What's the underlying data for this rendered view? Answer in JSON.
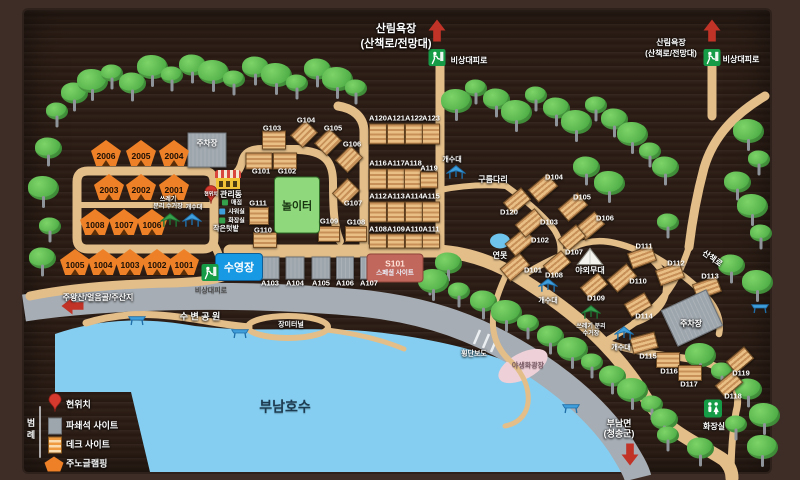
{
  "legend": {
    "title": "범례",
    "items": [
      {
        "icon": "pin",
        "label": "현위치"
      },
      {
        "icon": "gravel",
        "label": "파쇄석 사이트"
      },
      {
        "icon": "deck",
        "label": "데크 사이트"
      },
      {
        "icon": "glamping",
        "label": "주노글램핑"
      }
    ]
  },
  "colors": {
    "board": "#2c1d15",
    "road_tan": "#e3be89",
    "road_gray": "#a6adb4",
    "lake": "#85cef1",
    "tent_orange": "#ee8127",
    "deck_tan": "#e9bf85",
    "gravel_gray": "#9ea6ad",
    "pool_blue": "#1899e3",
    "playground_green": "#8fd87b",
    "special_red": "#c2675c",
    "exit_green": "#169c46",
    "arrow_red": "#c23327"
  },
  "map": {
    "tents": [
      [
        "2006",
        106,
        153
      ],
      [
        "2005",
        141,
        153
      ],
      [
        "2004",
        174,
        153
      ],
      [
        "2003",
        109,
        187
      ],
      [
        "2002",
        141,
        187
      ],
      [
        "2001",
        174,
        187
      ],
      [
        "1008",
        95,
        222
      ],
      [
        "1007",
        124,
        222
      ],
      [
        "1006",
        152,
        222
      ],
      [
        "1005",
        75,
        262
      ],
      [
        "1004",
        103,
        262
      ],
      [
        "1003",
        130,
        262
      ],
      [
        "1002",
        157,
        262
      ],
      [
        "1001",
        184,
        262
      ]
    ],
    "deck_sites": [
      [
        "A120",
        378,
        134,
        16,
        19,
        0,
        378,
        118
      ],
      [
        "A121",
        396,
        134,
        16,
        19,
        0,
        396,
        118
      ],
      [
        "A122",
        414,
        134,
        16,
        19,
        0,
        414,
        118
      ],
      [
        "A123",
        431,
        134,
        16,
        19,
        0,
        431,
        118
      ],
      [
        "A116",
        378,
        179,
        16,
        19,
        0,
        378,
        163
      ],
      [
        "A117",
        396,
        179,
        16,
        19,
        0,
        396,
        163
      ],
      [
        "A118",
        413,
        179,
        16,
        19,
        0,
        413,
        163
      ],
      [
        "A119",
        429,
        180,
        16,
        15,
        0,
        429,
        168
      ],
      [
        "A112",
        378,
        212,
        16,
        19,
        0,
        378,
        196
      ],
      [
        "A113",
        396,
        212,
        16,
        19,
        0,
        396,
        196
      ],
      [
        "A114",
        414,
        212,
        16,
        19,
        0,
        414,
        196
      ],
      [
        "A115",
        431,
        212,
        16,
        19,
        0,
        431,
        196
      ],
      [
        "A108",
        378,
        241,
        16,
        13,
        0,
        378,
        229
      ],
      [
        "A109",
        396,
        241,
        16,
        13,
        0,
        396,
        229
      ],
      [
        "A110",
        414,
        241,
        16,
        13,
        0,
        414,
        229
      ],
      [
        "A111",
        431,
        241,
        16,
        13,
        0,
        431,
        229
      ],
      [
        "G101",
        259,
        161,
        25,
        15,
        0,
        261,
        171
      ],
      [
        "G102",
        285,
        161,
        22,
        15,
        0,
        287,
        171
      ],
      [
        "G103",
        274,
        140,
        22,
        17,
        0,
        272,
        128
      ],
      [
        "G104",
        304,
        134,
        20,
        16,
        -45,
        306,
        120
      ],
      [
        "G105",
        328,
        142,
        20,
        16,
        -45,
        333,
        128
      ],
      [
        "G106",
        349,
        159,
        20,
        16,
        -45,
        352,
        144
      ],
      [
        "G107",
        346,
        192,
        20,
        16,
        -45,
        353,
        203
      ],
      [
        "G108",
        356,
        234,
        20,
        14,
        0,
        356,
        222
      ],
      [
        "G109",
        329,
        234,
        20,
        14,
        0,
        329,
        221
      ],
      [
        "G110",
        265,
        240,
        22,
        14,
        0,
        263,
        230
      ],
      [
        "G111",
        259,
        216,
        18,
        16,
        0,
        258,
        203
      ],
      [
        "D101",
        515,
        267,
        24,
        15,
        -40,
        533,
        270
      ],
      [
        "D102",
        520,
        242,
        24,
        15,
        -40,
        540,
        240
      ],
      [
        "D103",
        530,
        223,
        24,
        15,
        -40,
        549,
        222
      ],
      [
        "D104",
        543,
        188,
        24,
        15,
        -40,
        554,
        177
      ],
      [
        "D105",
        573,
        207,
        24,
        15,
        -40,
        582,
        197
      ],
      [
        "D106",
        590,
        226,
        24,
        15,
        -40,
        605,
        218
      ],
      [
        "D107",
        572,
        238,
        22,
        14,
        -40,
        574,
        252
      ],
      [
        "D108",
        557,
        264,
        22,
        14,
        -40,
        554,
        275
      ],
      [
        "D109",
        594,
        286,
        22,
        14,
        -40,
        596,
        298
      ],
      [
        "D110",
        622,
        278,
        24,
        15,
        -40,
        638,
        281
      ],
      [
        "D111",
        642,
        257,
        24,
        15,
        -20,
        644,
        246
      ],
      [
        "D112",
        670,
        274,
        24,
        15,
        -20,
        676,
        263
      ],
      [
        "D113",
        707,
        288,
        24,
        15,
        -20,
        710,
        276
      ],
      [
        "D114",
        638,
        305,
        22,
        14,
        -30,
        644,
        316
      ],
      [
        "D115",
        644,
        343,
        24,
        15,
        -15,
        648,
        356
      ],
      [
        "D116",
        668,
        360,
        22,
        14,
        0,
        669,
        371
      ],
      [
        "D117",
        690,
        373,
        22,
        14,
        0,
        689,
        384
      ],
      [
        "D118",
        729,
        384,
        22,
        14,
        -40,
        733,
        396
      ],
      [
        "D119",
        740,
        360,
        22,
        14,
        -40,
        741,
        373
      ],
      [
        "D120",
        517,
        201,
        22,
        14,
        -40,
        509,
        212
      ]
    ],
    "gravel_sites": [
      {
        "id": "A103",
        "x": 270,
        "y": 268,
        "w": 17,
        "h": 21,
        "rot": 0,
        "lx": 270,
        "ly": 283
      },
      {
        "id": "A104",
        "x": 295,
        "y": 268,
        "w": 17,
        "h": 21,
        "rot": 0,
        "lx": 295,
        "ly": 283
      },
      {
        "id": "A105",
        "x": 321,
        "y": 268,
        "w": 17,
        "h": 21,
        "rot": 0,
        "lx": 321,
        "ly": 283
      },
      {
        "id": "A106",
        "x": 345,
        "y": 268,
        "w": 16,
        "h": 21,
        "rot": 0,
        "lx": 345,
        "ly": 283
      },
      {
        "id": "A107",
        "x": 369,
        "y": 268,
        "w": 16,
        "h": 21,
        "rot": 0,
        "lx": 369,
        "ly": 283
      },
      {
        "id": "주차장",
        "x": 207,
        "y": 150,
        "w": 37,
        "h": 33,
        "rot": 0,
        "lx": 207,
        "ly": 143
      },
      {
        "id": "주차장",
        "x": 692,
        "y": 318,
        "w": 48,
        "h": 38,
        "rot": -25,
        "lx": 691,
        "ly": 324
      }
    ],
    "pool": {
      "x": 239,
      "y": 267,
      "w": 46,
      "h": 26,
      "label": "수영장"
    },
    "playground": {
      "x": 297,
      "y": 205,
      "w": 44,
      "h": 55,
      "label": "놀이터"
    },
    "special": {
      "x": 395,
      "y": 268,
      "w": 55,
      "h": 27,
      "line1": "S101",
      "line2": "스페셜 사이트"
    },
    "office_amenities": [
      {
        "color": "#35a14c",
        "label": "매점"
      },
      {
        "color": "#3f9fdc",
        "label": "샤워실"
      },
      {
        "color": "#35a14c",
        "label": "화장실"
      }
    ],
    "labels": [
      [
        "산림욕장",
        396,
        30,
        11,
        "w",
        0
      ],
      [
        "(산책로/전망대)",
        396,
        45,
        11,
        "w",
        0
      ],
      [
        "비상대피로",
        469,
        61,
        8,
        "w",
        0
      ],
      [
        "산림욕장",
        671,
        43,
        8,
        "w",
        0
      ],
      [
        "(산책로/전망대)",
        671,
        54,
        8,
        "w",
        0
      ],
      [
        "비상대피로",
        741,
        60,
        8,
        "w",
        0
      ],
      [
        "주왕산/얼음골/주산지",
        98,
        298,
        8,
        "w",
        0
      ],
      [
        "비상대피로",
        211,
        291,
        7,
        "#474747",
        0
      ],
      [
        "수 변 공 원",
        200,
        317,
        9,
        "w",
        0
      ],
      [
        "장미터널",
        291,
        325,
        7,
        "w",
        0
      ],
      [
        "횡단보도",
        474,
        354,
        7,
        "w",
        0
      ],
      [
        "야생화광장",
        528,
        366,
        7,
        "#7b5b66",
        0
      ],
      [
        "부남호수",
        285,
        407,
        14,
        "#1d3b50",
        0
      ],
      [
        "부남면",
        619,
        424,
        9,
        "w",
        0
      ],
      [
        "(청송군)",
        619,
        434,
        9,
        "w",
        0
      ],
      [
        "산책로",
        712,
        259,
        8,
        "w",
        35
      ],
      [
        "구름다리",
        493,
        180,
        8,
        "w",
        0
      ],
      [
        "작은텃밭",
        226,
        229,
        7,
        "w",
        0
      ],
      [
        "연못",
        500,
        256,
        8,
        "w",
        0
      ],
      [
        "야외무대",
        590,
        271,
        8,
        "w",
        0
      ],
      [
        "관리동",
        231,
        195,
        8,
        "w",
        0
      ],
      [
        "쓰레기",
        168,
        200,
        6,
        "w",
        0
      ],
      [
        "분리 수거장",
        168,
        207,
        6,
        "w",
        0
      ],
      [
        "개수대",
        194,
        208,
        6,
        "w",
        0
      ],
      [
        "개수대",
        452,
        160,
        7,
        "w",
        0
      ],
      [
        "개수대",
        548,
        301,
        7,
        "w",
        0
      ],
      [
        "쓰레기 분리",
        591,
        327,
        6,
        "w",
        0
      ],
      [
        "수거장",
        591,
        334,
        6,
        "w",
        0
      ],
      [
        "개수대",
        621,
        348,
        7,
        "w",
        0
      ],
      [
        "화장실",
        714,
        427,
        8,
        "w",
        0
      ],
      [
        "주차장",
        691,
        324,
        8,
        "w",
        0
      ],
      [
        "현위치",
        211,
        195,
        5,
        "w",
        0
      ]
    ],
    "icons": [
      [
        "exit",
        437,
        60
      ],
      [
        "exit",
        712,
        60
      ],
      [
        "exit",
        210,
        275
      ],
      [
        "arrow-up",
        437,
        33
      ],
      [
        "arrow-up",
        712,
        33
      ],
      [
        "arrow-left",
        75,
        306
      ],
      [
        "arrow-down",
        630,
        452
      ],
      [
        "canopy-green",
        170,
        224
      ],
      [
        "canopy-blue",
        192,
        224
      ],
      [
        "canopy-blue",
        456,
        176
      ],
      [
        "canopy-blue",
        548,
        289
      ],
      [
        "canopy-green",
        591,
        316
      ],
      [
        "canopy-blue",
        624,
        337
      ],
      [
        "table",
        137,
        322
      ],
      [
        "table",
        240,
        335
      ],
      [
        "table",
        760,
        310
      ],
      [
        "table",
        571,
        410
      ],
      [
        "toilet",
        713,
        411
      ],
      [
        "stage",
        590,
        259
      ],
      [
        "office",
        228,
        180
      ],
      [
        "pin",
        211,
        197
      ]
    ],
    "trees": [
      [
        57,
        116
      ],
      [
        74,
        98
      ],
      [
        92,
        86
      ],
      [
        112,
        78
      ],
      [
        132,
        88
      ],
      [
        152,
        72
      ],
      [
        172,
        80
      ],
      [
        192,
        70
      ],
      [
        213,
        77
      ],
      [
        234,
        84
      ],
      [
        255,
        72
      ],
      [
        276,
        80
      ],
      [
        297,
        88
      ],
      [
        317,
        74
      ],
      [
        337,
        84
      ],
      [
        356,
        93
      ],
      [
        48,
        153
      ],
      [
        43,
        193
      ],
      [
        50,
        231
      ],
      [
        42,
        263
      ],
      [
        456,
        106
      ],
      [
        476,
        93
      ],
      [
        496,
        104
      ],
      [
        516,
        117
      ],
      [
        536,
        100
      ],
      [
        556,
        113
      ],
      [
        576,
        127
      ],
      [
        596,
        110
      ],
      [
        614,
        124
      ],
      [
        632,
        139
      ],
      [
        650,
        156
      ],
      [
        665,
        172
      ],
      [
        748,
        136
      ],
      [
        759,
        164
      ],
      [
        737,
        187
      ],
      [
        752,
        211
      ],
      [
        761,
        238
      ],
      [
        586,
        172
      ],
      [
        609,
        188
      ],
      [
        668,
        227
      ],
      [
        731,
        270
      ],
      [
        757,
        287
      ],
      [
        430,
        284
      ],
      [
        448,
        268
      ],
      [
        433,
        286
      ],
      [
        459,
        296
      ],
      [
        483,
        306
      ],
      [
        506,
        317
      ],
      [
        528,
        328
      ],
      [
        550,
        341
      ],
      [
        572,
        354
      ],
      [
        592,
        367
      ],
      [
        612,
        381
      ],
      [
        632,
        395
      ],
      [
        652,
        409
      ],
      [
        664,
        424
      ],
      [
        700,
        360
      ],
      [
        722,
        376
      ],
      [
        748,
        394
      ],
      [
        764,
        420
      ],
      [
        736,
        429
      ],
      [
        700,
        453
      ],
      [
        762,
        452
      ],
      [
        668,
        440
      ]
    ]
  }
}
